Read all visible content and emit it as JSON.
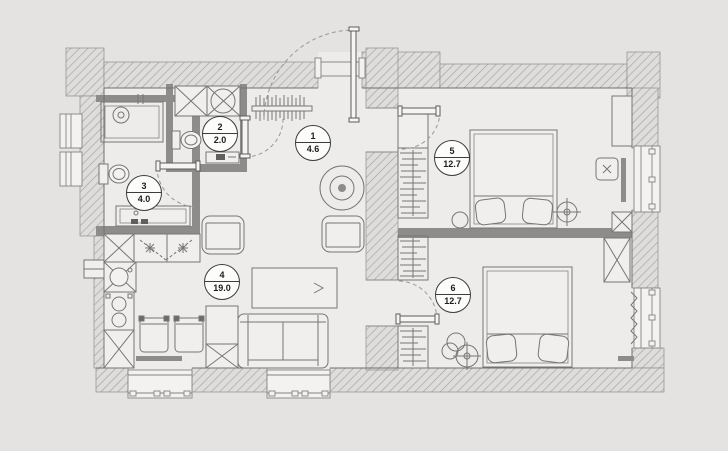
{
  "plan": {
    "type": "apartment-floor-plan",
    "colors": {
      "background": "#e4e3e1",
      "floor": "#edecea",
      "wall_hatch_line": "#a3a2a1",
      "wall_hatch_fill": "#dedddc",
      "wall_solid": "#8d8c8b",
      "furniture_line": "#767675",
      "label_border": "#3c3c3c"
    },
    "rooms": [
      {
        "number": "1",
        "area": "4.6",
        "name": "hallway"
      },
      {
        "number": "2",
        "area": "2.0",
        "name": "wc"
      },
      {
        "number": "3",
        "area": "4.0",
        "name": "bathroom"
      },
      {
        "number": "4",
        "area": "19.0",
        "name": "living-room-kitchen"
      },
      {
        "number": "5",
        "area": "12.7",
        "name": "bedroom-right-top"
      },
      {
        "number": "6",
        "area": "12.7",
        "name": "bedroom-right-bottom"
      }
    ]
  }
}
